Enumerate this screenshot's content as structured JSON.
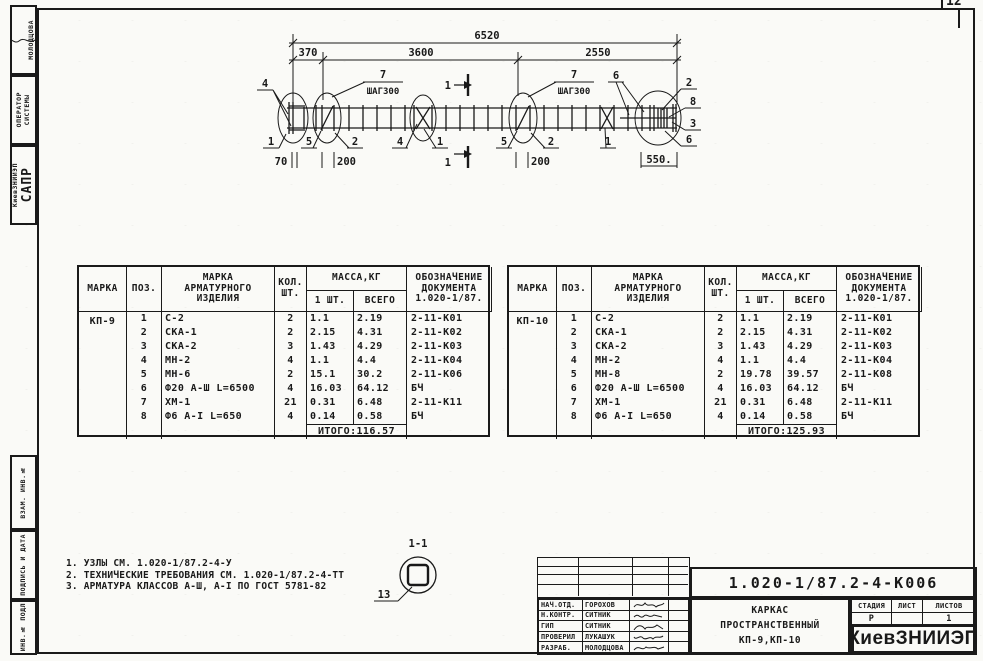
{
  "corner_page": "12",
  "margin": {
    "designer": "МОЛОДЦОВА",
    "role": "ОПЕРАТОР\nСИСТЕМЫ",
    "org_big": "САПР",
    "org_small": "КиевЗНИИЭП",
    "field_vzam": "ВЗАМ. ИНВ.№",
    "field_podpis": "ПОДПИСЬ И ДАТА",
    "field_inv": "ИНВ.№ ПОДЛ"
  },
  "drawing": {
    "dim_total": "6520",
    "seg1": "370",
    "seg2": "3600",
    "seg3": "2550",
    "step_num": "7",
    "step": "ШАГ300",
    "n1": "1",
    "n2": "2",
    "n3": "3",
    "n4": "4",
    "n5": "5",
    "n6": "6",
    "n8": "8",
    "dim_70": "70",
    "dim_200": "200",
    "dim_550": "550."
  },
  "table_headers": {
    "marka": "МАРКА",
    "poz": "ПОЗ.",
    "item": "МАРКА\nАРМАТУРНОГО\nИЗДЕЛИЯ",
    "qty": "КОЛ.\nШТ.",
    "mass": "МАССА,КГ",
    "one": "1 ШТ.",
    "all": "ВСЕГО",
    "doc": "ОБОЗНАЧЕНИЕ\nДОКУМЕНТА\n1.020-1/87."
  },
  "spec_tables": [
    {
      "marka": "КП-9",
      "rows": [
        [
          "1",
          "С-2",
          "2",
          "1.1",
          "2.19",
          "2-11-К01"
        ],
        [
          "2",
          "СКА-1",
          "2",
          "2.15",
          "4.31",
          "2-11-К02"
        ],
        [
          "3",
          "СКА-2",
          "3",
          "1.43",
          "4.29",
          "2-11-К03"
        ],
        [
          "4",
          "МН-2",
          "4",
          "1.1",
          "4.4",
          "2-11-К04"
        ],
        [
          "5",
          "МН-6",
          "2",
          "15.1",
          "30.2",
          "2-11-К06"
        ],
        [
          "6",
          "Ф20 А-Ш L=6500",
          "4",
          "16.03",
          "64.12",
          "БЧ"
        ],
        [
          "7",
          "ХМ-1",
          "21",
          "0.31",
          "6.48",
          "2-11-К11"
        ],
        [
          "8",
          "Ф6 А-I L=650",
          "4",
          "0.14",
          "0.58",
          "БЧ"
        ]
      ],
      "total": "ИТОГО:116.57"
    },
    {
      "marka": "КП-10",
      "rows": [
        [
          "1",
          "С-2",
          "2",
          "1.1",
          "2.19",
          "2-11-К01"
        ],
        [
          "2",
          "СКА-1",
          "2",
          "2.15",
          "4.31",
          "2-11-К02"
        ],
        [
          "3",
          "СКА-2",
          "3",
          "1.43",
          "4.29",
          "2-11-К03"
        ],
        [
          "4",
          "МН-2",
          "4",
          "1.1",
          "4.4",
          "2-11-К04"
        ],
        [
          "5",
          "МН-8",
          "2",
          "19.78",
          "39.57",
          "2-11-К08"
        ],
        [
          "6",
          "Ф20 А-Ш L=6500",
          "4",
          "16.03",
          "64.12",
          "БЧ"
        ],
        [
          "7",
          "ХМ-1",
          "21",
          "0.31",
          "6.48",
          "2-11-К11"
        ],
        [
          "8",
          "Ф6 А-I L=650",
          "4",
          "0.14",
          "0.58",
          "БЧ"
        ]
      ],
      "total": "ИТОГО:125.93"
    }
  ],
  "notes": [
    "1. УЗЛЫ СМ. 1.020-1/87.2-4-У",
    "2. ТЕХНИЧЕСКИЕ ТРЕБОВАНИЯ СМ. 1.020-1/87.2-4-ТТ",
    "3. АРМАТУРА КЛАССОВ А-Ш, А-I ПО ГОСТ 5781-82"
  ],
  "section_detail": {
    "title": "1-1",
    "pos": "13"
  },
  "title_block": {
    "doc_number": "1.020-1/87.2-4-К006",
    "rows": [
      {
        "role": "НАЧ.ОТД.",
        "name": "ГОРОХОВ"
      },
      {
        "role": "Н.КОНТР.",
        "name": "СИТНИК"
      },
      {
        "role": "ГИП",
        "name": "СИТНИК"
      },
      {
        "role": "ПРОВЕРИЛ",
        "name": "ЛУКАШУК"
      },
      {
        "role": "РАЗРАБ.",
        "name": "МОЛОДЦОВА"
      }
    ],
    "title": "КАРКАС\nПРОСТРАНСТВЕННЫЙ\nКП-9,КП-10",
    "stage_label": "СТАДИЯ",
    "sheet_label": "ЛИСТ",
    "sheets_label": "ЛИСТОВ",
    "stage_value": "Р",
    "sheet_value": "",
    "sheets_value": "1",
    "org": "КиевЗНИИЭП"
  }
}
